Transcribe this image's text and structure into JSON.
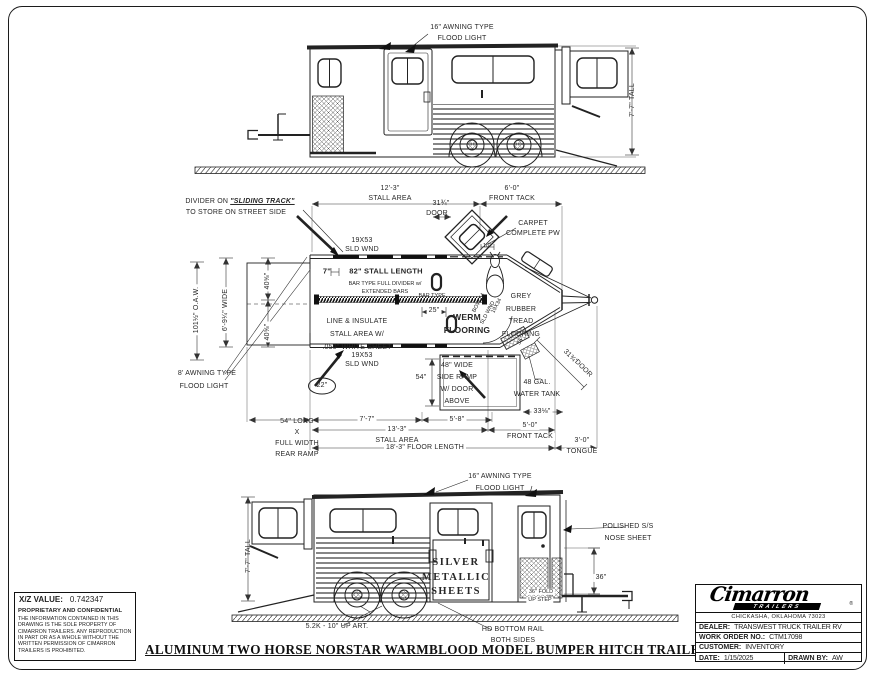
{
  "sheet": {
    "title": "ALUMINUM TWO HORSE NORSTAR WARMBLOOD MODEL BUMPER HITCH TRAILER-SR"
  },
  "top_view": {
    "awning_light_1": "16\" AWNING TYPE",
    "awning_light_2": "FLOOD LIGHT",
    "height": "7'-7\" TALL"
  },
  "plan_view": {
    "divider_note_1": "DIVIDER ON",
    "divider_note_track": "\"SLIDING TRACK\"",
    "divider_note_2": "TO STORE ON STREET SIDE",
    "stall_area_top_dim": "12'-3\"",
    "stall_area_top_label": "STALL AREA",
    "front_tack_top_dim": "6'-0\"",
    "front_tack_top_label": "FRONT TACK",
    "door_top_dim": "31¾\"",
    "door_top_label": "DOOR",
    "window_top_1": "19X53",
    "window_top_2": "SLD WND",
    "carpet_1": "CARPET",
    "carpet_2": "COMPLETE PW",
    "offset_dim": "7\"",
    "stall_length": "82\" STALL LENGTH",
    "stall_length_sub_1": "BAR TYPE FULL DIVIDER w/",
    "stall_length_sub_2": "EXTENDED BARS",
    "bar_type": "BAR TYPE",
    "tie_dim": "25\"",
    "werm_1": "WERM",
    "werm_2": "FLOORING",
    "insulate_1": "LINE & INSULATE",
    "insulate_2": "STALL AREA W/",
    "insulate_3": ".050\" WHITE SHEET",
    "oaw_dim": "101½\" O.A.W.",
    "width_dim": "6'-9¼\" WIDE",
    "stall_width_dim_1": "40⅝\"",
    "stall_width_dim_2": "40⅝\"",
    "grey_1": "GREY",
    "grey_2": "RUBBER",
    "grey_3": "TREAD",
    "grey_4": "FLOORING",
    "nose_window_size": "19X34",
    "nose_window_label": "SLD WND",
    "bow_label": "BOW 54",
    "nose_dim_18": "18\"",
    "awning_1": "8' AWNING TYPE",
    "awning_2": "FLOOD LIGHT",
    "dim_22": "22\"",
    "window_bottom_1": "19X53",
    "window_bottom_2": "SLD WND",
    "side_ramp_height": "54\"",
    "side_ramp_1": "48\" WIDE",
    "side_ramp_2": "SIDE RAMP",
    "side_ramp_3": "W/ DOOR",
    "side_ramp_4": "ABOVE",
    "water_tank_1": "48 GAL.",
    "water_tank_2": "WATER TANK",
    "door_diag_dim": "31¾\"",
    "door_diag_label": "DOOR",
    "step_dim_rot": "36\"",
    "rear_ramp_1": "54\" LONG",
    "rear_ramp_2": "X",
    "rear_ramp_3": "FULL WIDTH",
    "rear_ramp_4": "REAR RAMP",
    "dim_7_7": "7'-7\"",
    "stall_area_bottom_dim": "13'-3\"",
    "stall_area_bottom_label": "STALL AREA",
    "dim_5_8": "5'-8\"",
    "dim_33": "33⅛\"",
    "front_tack_bottom_dim": "5'-0\"",
    "front_tack_bottom_label": "FRONT TACK",
    "floor_length_dim": "18'-3\" FLOOR LENGTH",
    "tongue_dim": "3'-0\"",
    "tongue_label": "TONGUE"
  },
  "bottom_view": {
    "awning_light_1": "16\" AWNING TYPE",
    "awning_light_2": "FLOOD LIGHT",
    "nose_sheet_1": "POLISHED S/S",
    "nose_sheet_2": "NOSE SHEET",
    "height": "7'-7\" TALL",
    "silver_1": "SILVER",
    "silver_2": "METALLIC",
    "silver_3": "SHEETS",
    "step_height_dim": "36\"",
    "fold_step_1": "36\" FOLD",
    "fold_step_2": "UP STEP",
    "axle_note": "5.2K - 10\" UP ART.",
    "bottom_rail_1": "HD BOTTOM RAIL",
    "bottom_rail_2": "BOTH SIDES"
  },
  "info_box": {
    "xz_label": "X/Z VALUE:",
    "xz_value": "0.742347",
    "confidential_title": "PROPRIETARY AND CONFIDENTIAL",
    "confidential_text": "THE INFORMATION CONTAINED IN THIS DRAWING IS THE SOLE PROPERTY OF CIMARRON TRAILERS.  ANY REPRODUCTION IN PART OR AS A WHOLE WITHOUT THE WRITTEN PERMISSION OF CIMARRON TRAILERS IS PROHIBITED."
  },
  "title_block": {
    "brand": "Cimarron",
    "brand_sub": "TRAILERS",
    "registered": "®",
    "address": "CHICKASHA, OKLAHOMA 73023",
    "dealer_label": "DEALER:",
    "dealer_value": "TRANSWEST TRUCK TRAILER RV",
    "work_order_label": "WORK ORDER NO.:",
    "work_order_value": "CTM17098",
    "customer_label": "CUSTOMER:",
    "customer_value": "INVENTORY",
    "date_label": "DATE:",
    "date_value": "1/15/2025",
    "drawn_by_label": "DRAWN BY:",
    "drawn_by_value": "AW"
  }
}
